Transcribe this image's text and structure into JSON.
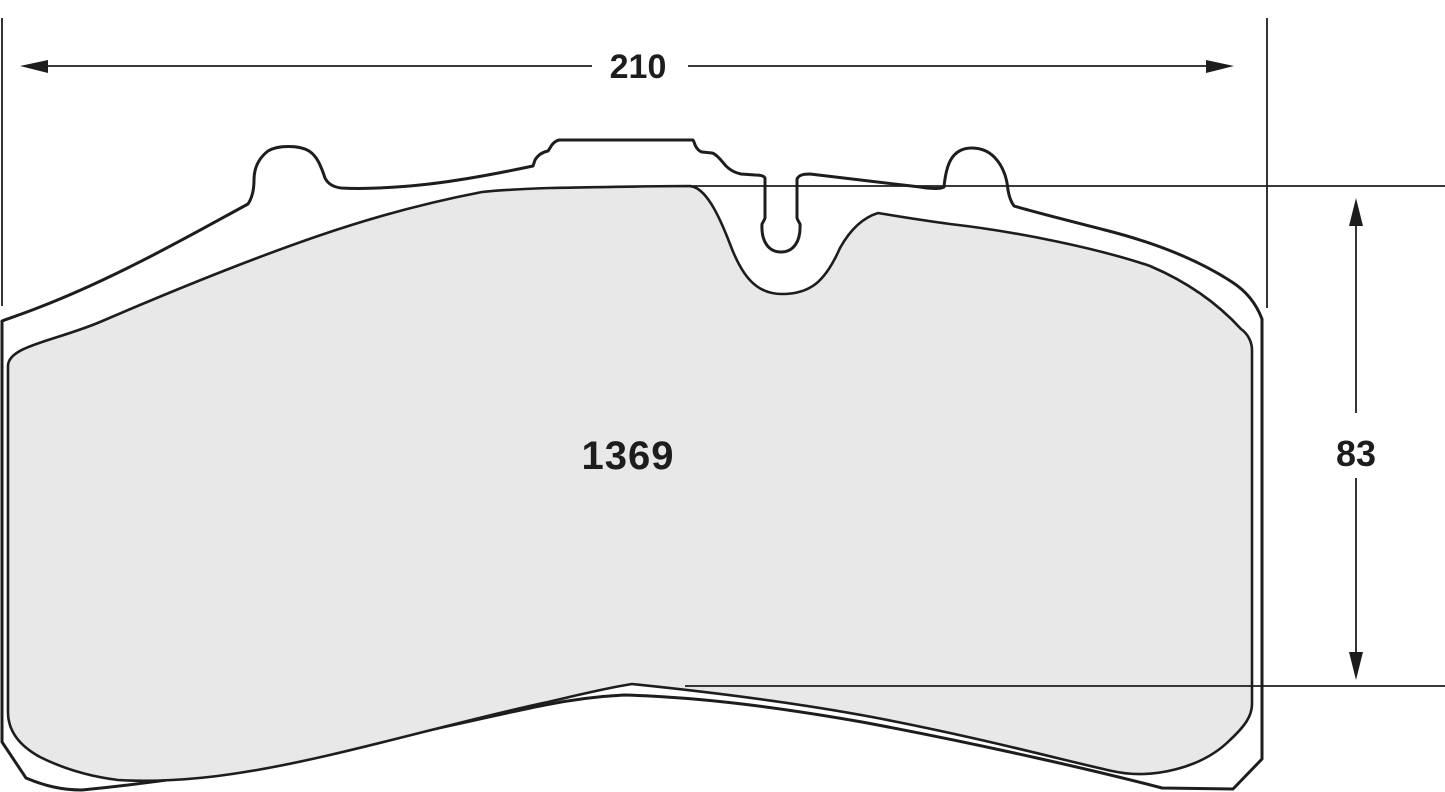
{
  "diagram": {
    "part_number": "1369",
    "dimensions": {
      "width": "210",
      "height": "83"
    },
    "colors": {
      "line": "#1d1d1b",
      "friction_fill": "#e8e8e9",
      "background": "#ffffff"
    }
  }
}
